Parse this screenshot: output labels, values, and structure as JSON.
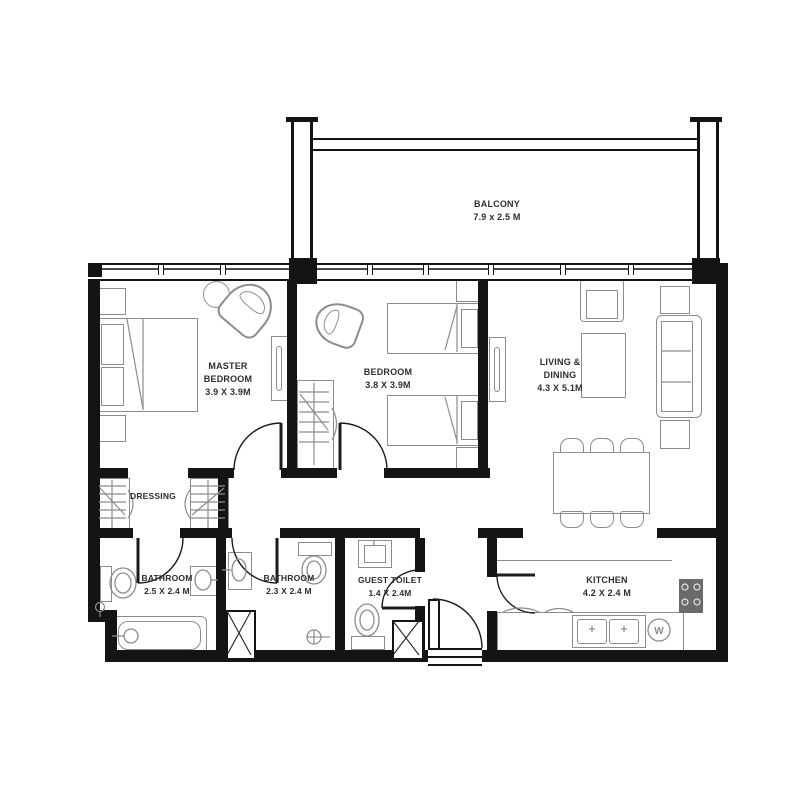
{
  "floorplan": {
    "rooms": {
      "balcony": {
        "name": "BALCONY",
        "dims": "7.9 x 2.5 M"
      },
      "master_bedroom": {
        "name_line1": "MASTER",
        "name_line2": "BEDROOM",
        "dims": "3.9 X 3.9M"
      },
      "bedroom": {
        "name": "BEDROOM",
        "dims": "3.8 X 3.9M"
      },
      "living_dining": {
        "name_line1": "LIVING &",
        "name_line2": "DINING",
        "dims": "4.3 X 5.1M"
      },
      "dressing": {
        "name": "DRESSING"
      },
      "bathroom_master": {
        "name": "BATHROOM",
        "dims": "2.5 X 2.4 M"
      },
      "bathroom_shared": {
        "name": "BATHROOM",
        "dims": "2.3 X 2.4 M"
      },
      "guest_toilet": {
        "name": "GUEST TOILET",
        "dims": "1.4 X 2.4M"
      },
      "kitchen": {
        "name": "KITCHEN",
        "dims": "4.2 X 2.4 M"
      }
    },
    "appliances": {
      "washing_machine_label": "W"
    },
    "colors": {
      "wall": "#141414",
      "furniture_outline": "#8c8c8c",
      "label_text": "#2e2e2e",
      "background": "#ffffff"
    }
  }
}
